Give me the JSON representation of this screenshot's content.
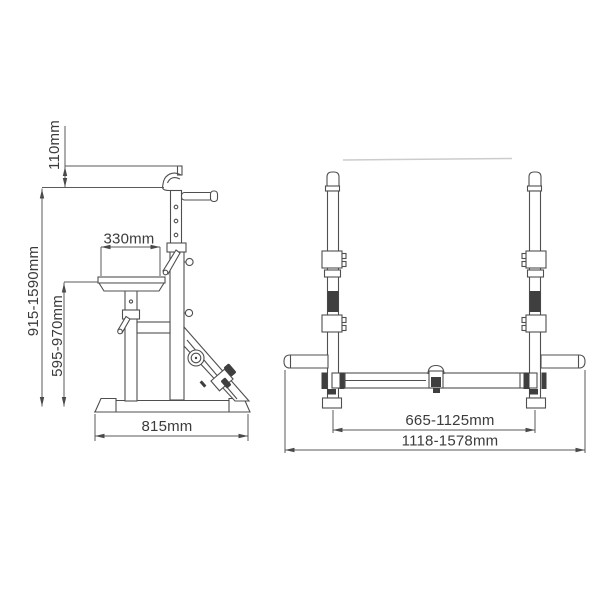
{
  "drawing": {
    "subject": "adjustable-barbell-rack-dimension-drawing",
    "colors": {
      "background": "#ffffff",
      "line": "#4f4f4f",
      "text": "#3b3b3b",
      "dark_fill": "#3f3f3f",
      "faint_line": "#cccccc"
    },
    "side_view": {
      "dims": {
        "post_top_offset": {
          "label": "110mm",
          "orientation": "vertical"
        },
        "rack_height_range": {
          "label": "915-1590mm",
          "orientation": "vertical"
        },
        "seat_height_range": {
          "label": "595-970mm",
          "orientation": "vertical"
        },
        "seat_length": {
          "label": "330mm",
          "orientation": "horizontal"
        },
        "base_length": {
          "label": "815mm",
          "orientation": "horizontal"
        }
      }
    },
    "front_view": {
      "dims": {
        "inner_width_range": {
          "label": "665-1125mm",
          "orientation": "horizontal"
        },
        "overall_width_range": {
          "label": "1118-1578mm",
          "orientation": "horizontal"
        }
      }
    }
  }
}
